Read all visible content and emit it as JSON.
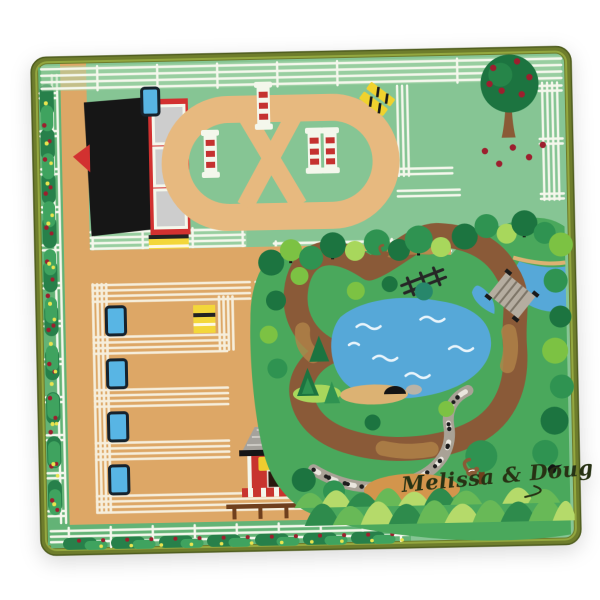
{
  "brand": {
    "signature": "Melissa & Doug"
  },
  "scene": {
    "stalls": 4,
    "water_troughs": 5,
    "striped_jump_poles": 4,
    "hay_bales": 2,
    "stable_windows": 3
  },
  "palette": {
    "page_bg": "#ffffff",
    "binding": "#6e7d2c",
    "binding_dark": "#4f5d1f",
    "binding_light": "#93a73f",
    "field": "#86c594",
    "field_light": "#a9d8ab",
    "hedge_bg": "#63b376",
    "bush_dark": "#27804a",
    "bush_mid": "#3fa35f",
    "flower_red": "#9c1f2e",
    "flower_yellow": "#e9e44f",
    "fence_white": "#f4f7ec",
    "stall_cream": "#f6eedb",
    "track_tan": "#e7b97f",
    "yard_tan": "#dda766",
    "trough_blue": "#58b5e4",
    "trough_dark": "#16222c",
    "pole_red": "#c53230",
    "jump_yellow": "#f0d22e",
    "stable_red": "#d23130",
    "roof_black": "#161616",
    "window_gray": "#cdcdcd",
    "hay_yellow": "#f3d73a",
    "nature_green": "#4aa85c",
    "tree_dark": "#1c7440",
    "tree_mid": "#2f9351",
    "tree_light": "#7cc243",
    "tree_pale": "#a8d75c",
    "tree_teal": "#27876b",
    "trail_brown": "#8a5a38",
    "trail_light": "#b08348",
    "pond_blue": "#56a8d8",
    "wave_white": "#e8f4fb",
    "sand_tan": "#dcb273",
    "pebble_gray": "#a9a296",
    "pebble_white": "#eae6de",
    "pebble_black": "#1d1d1d",
    "bridge_gray": "#b5ada0",
    "bridge_dark": "#7e7668",
    "barn_red": "#c8342e",
    "barn_roof": "#a5a29c",
    "barn_roof_light": "#ccc9c3",
    "sign_yellow": "#efcd2f",
    "door_dark": "#2a180e",
    "rail_brown": "#6f3f1d",
    "bush_row_light": "#b5da6a",
    "bush_row_mid": "#68b957",
    "bush_row_dark": "#2e8b4c",
    "signature_ink": "#273214",
    "dirt_orange": "#d3954c",
    "animal_brown": "#8a5a36"
  }
}
